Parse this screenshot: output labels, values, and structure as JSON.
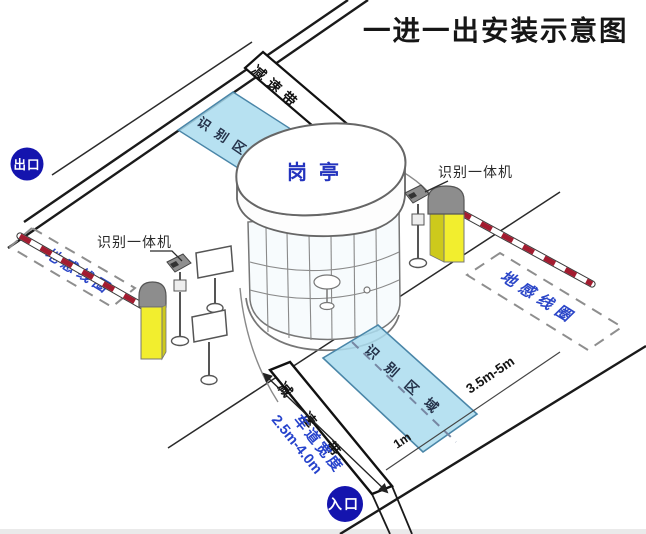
{
  "title": "一进一出安装示意图",
  "markers": {
    "exit": "出口",
    "entrance": "入口"
  },
  "booth": {
    "label": "岗亭"
  },
  "equipment": {
    "left_camera_label": "识别一体机",
    "right_camera_label": "识别一体机"
  },
  "zones": {
    "left_ground_coil": "地感线圈",
    "right_ground_coil": "地感线圈",
    "top_recognition_area": "识别区域",
    "bottom_recognition_area": "识别区域",
    "top_speed_bump": "减速带",
    "bottom_speed_bump": "减速带"
  },
  "measurements": {
    "lane_width_label": "车道宽度",
    "lane_width_value": "2.5m-4.0m",
    "coil_distance": "3.5m-5m",
    "stop_line_distance": "1m"
  },
  "colors": {
    "badge_blue": "#1414ae",
    "booth_label_blue": "#2333be",
    "coil_text_blue": "#2b46c8",
    "lane_width_blue": "#2643cc",
    "recognition_area_fill": "#aadcee",
    "barrier_yellow": "#f2ee2e",
    "arm_stripe_red": "#a31c30",
    "line_black": "#1a1a1a"
  }
}
